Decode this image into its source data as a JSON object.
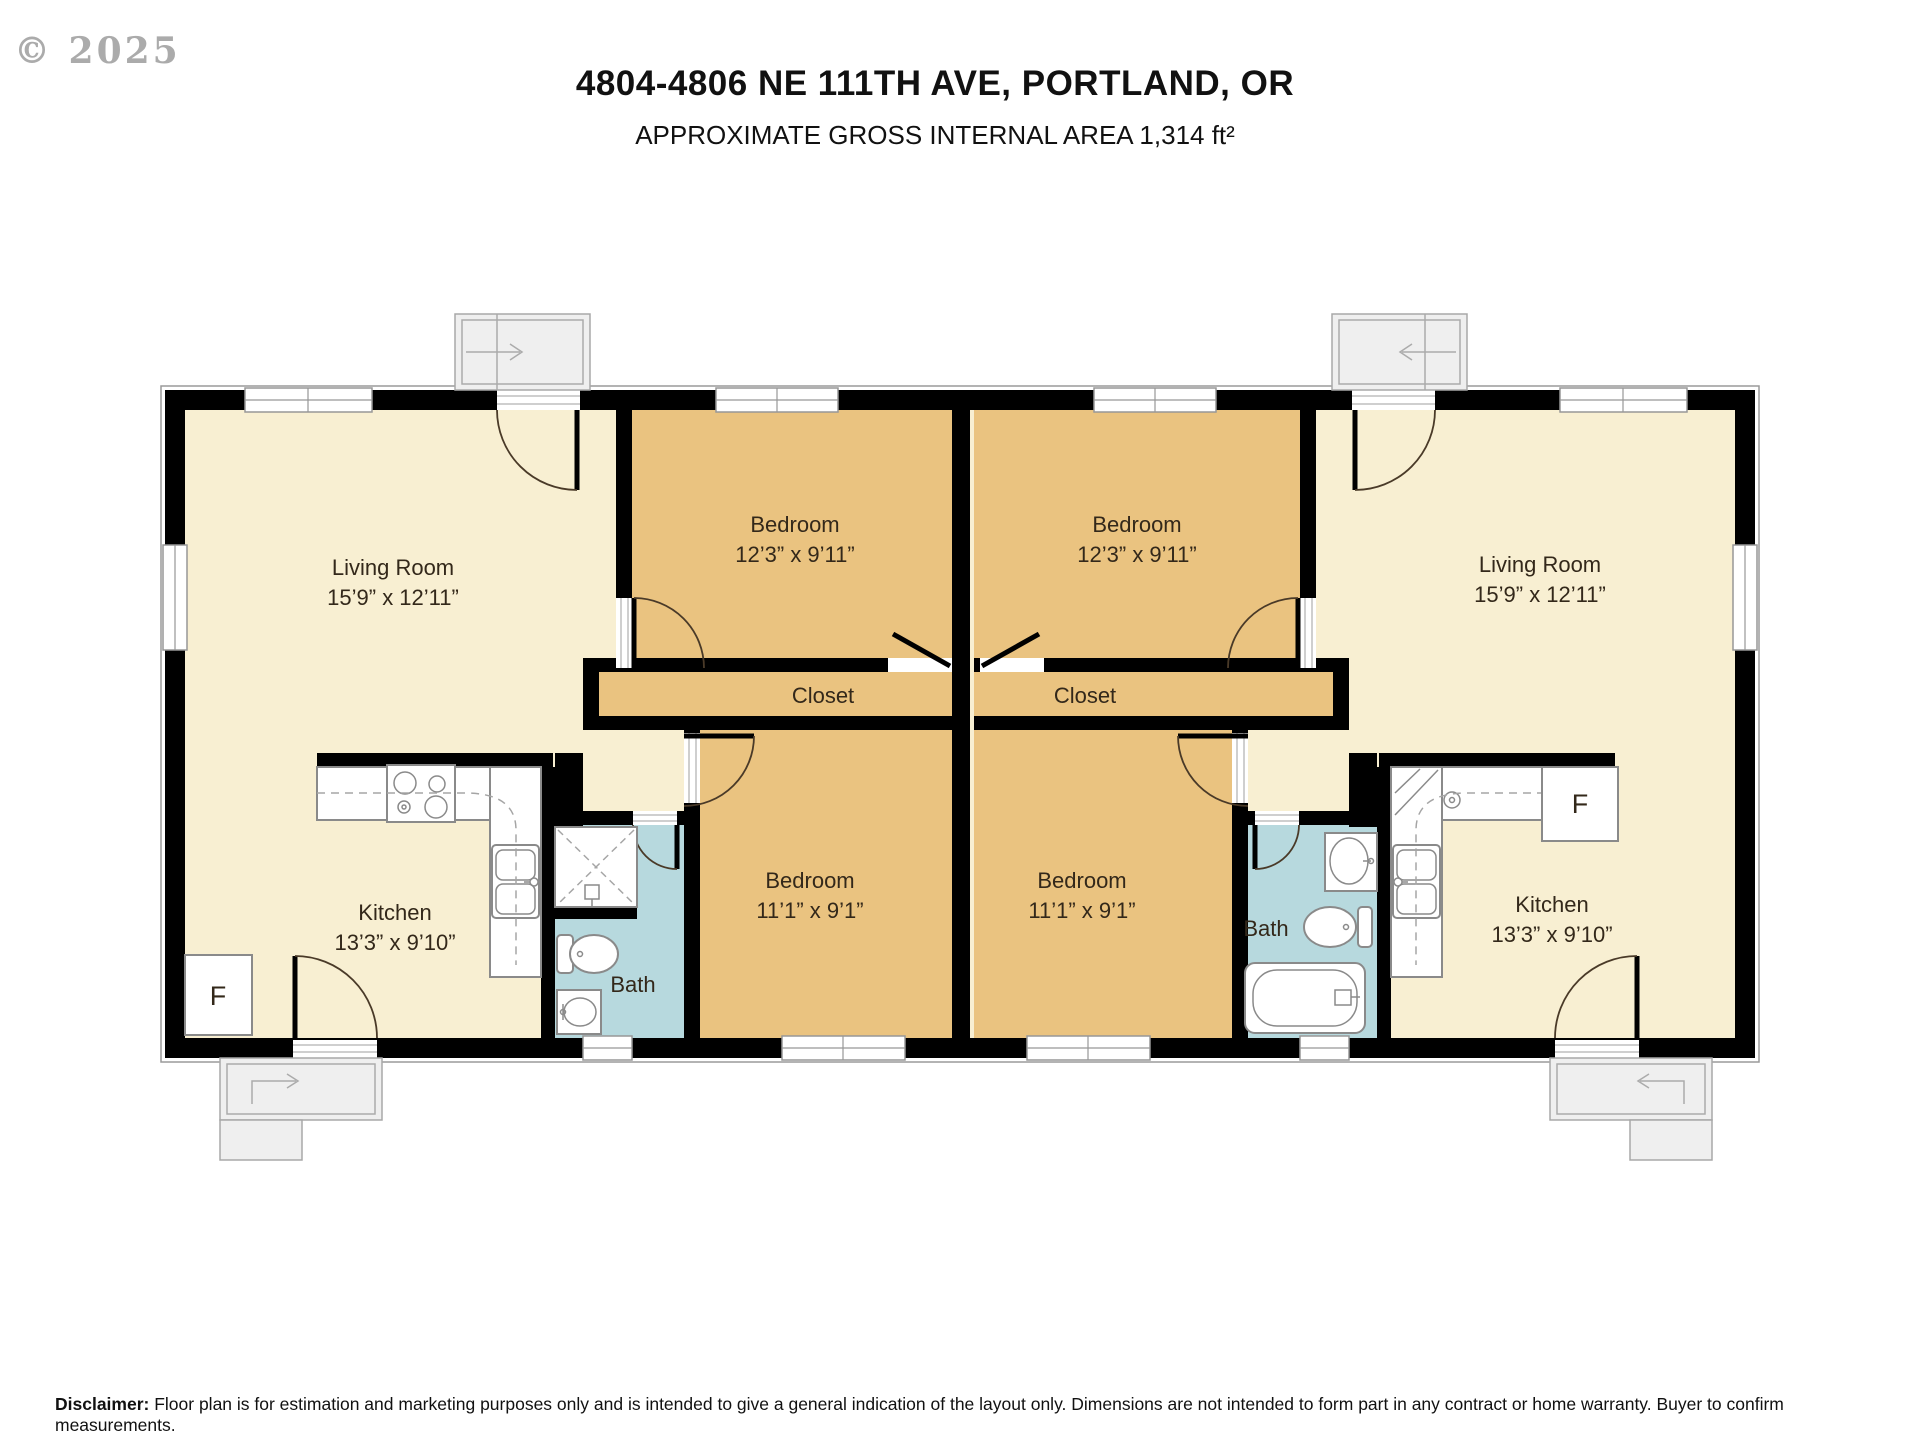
{
  "header": {
    "copyright": "© 2025",
    "title": "4804-4806 NE 111TH AVE, PORTLAND, OR",
    "subtitle": "APPROXIMATE GROSS INTERNAL AREA 1,314 ft²"
  },
  "rooms": {
    "living": {
      "name": "Living Room",
      "dims": "15’9” x 12’11”"
    },
    "bedroom_large": {
      "name": "Bedroom",
      "dims": "12’3” x 9’11”"
    },
    "bedroom_small": {
      "name": "Bedroom",
      "dims": "11’1” x 9’1”"
    },
    "kitchen": {
      "name": "Kitchen",
      "dims": "13’3” x 9’10”"
    },
    "closet": "Closet",
    "bath": "Bath",
    "fridge": "F"
  },
  "disclaimer": {
    "label": "Disclaimer:",
    "text": " Floor plan is for estimation and marketing purposes only and is intended to give a general indication of the layout only. Dimensions are not intended to form part in any contract or home warranty. Buyer to confirm measurements."
  },
  "colors": {
    "floor": "#F8EFD2",
    "bedroom": "#EAC380",
    "bath": "#B7D9DE",
    "wall": "#000000",
    "label": "#33281A"
  }
}
